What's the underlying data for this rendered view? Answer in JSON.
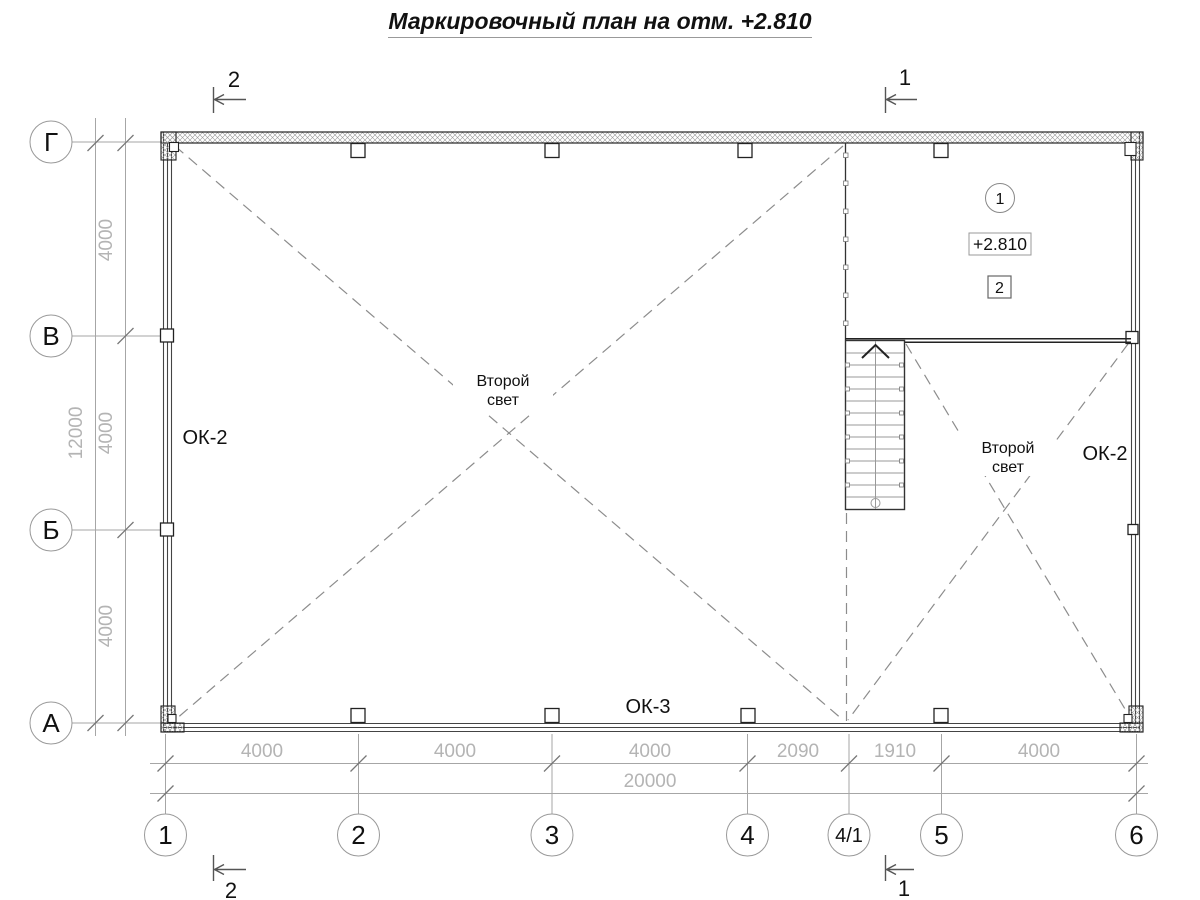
{
  "title": "Маркировочный план на отм. +2.810",
  "axes": {
    "rows": [
      "Г",
      "В",
      "Б",
      "А"
    ],
    "cols": [
      "1",
      "2",
      "3",
      "4",
      "4/1",
      "5",
      "6"
    ]
  },
  "dims": {
    "left": {
      "segments": [
        "4000",
        "4000",
        "4000"
      ],
      "total": "12000"
    },
    "bottom": {
      "segments": [
        "4000",
        "4000",
        "4000",
        "2090",
        "1910",
        "4000"
      ],
      "total": "20000"
    }
  },
  "sections": {
    "top_left": "2",
    "top_right": "1",
    "bottom_left": "2",
    "bottom_right": "1"
  },
  "labels": {
    "window_left": "ОК-2",
    "window_right": "ОК-2",
    "window_bottom": "ОК-3",
    "void_left_line1": "Второй",
    "void_left_line2": "свет",
    "void_right_line1": "Второй",
    "void_right_line2": "свет"
  },
  "markers": {
    "stair_axis": "1",
    "elevation": "+2.810",
    "room": "2"
  },
  "colors": {
    "line": "#222222",
    "dim_text": "#b4b4b4",
    "dim_line": "#a6a6a6",
    "dashed": "#8c8c8c",
    "bg": "#ffffff"
  }
}
